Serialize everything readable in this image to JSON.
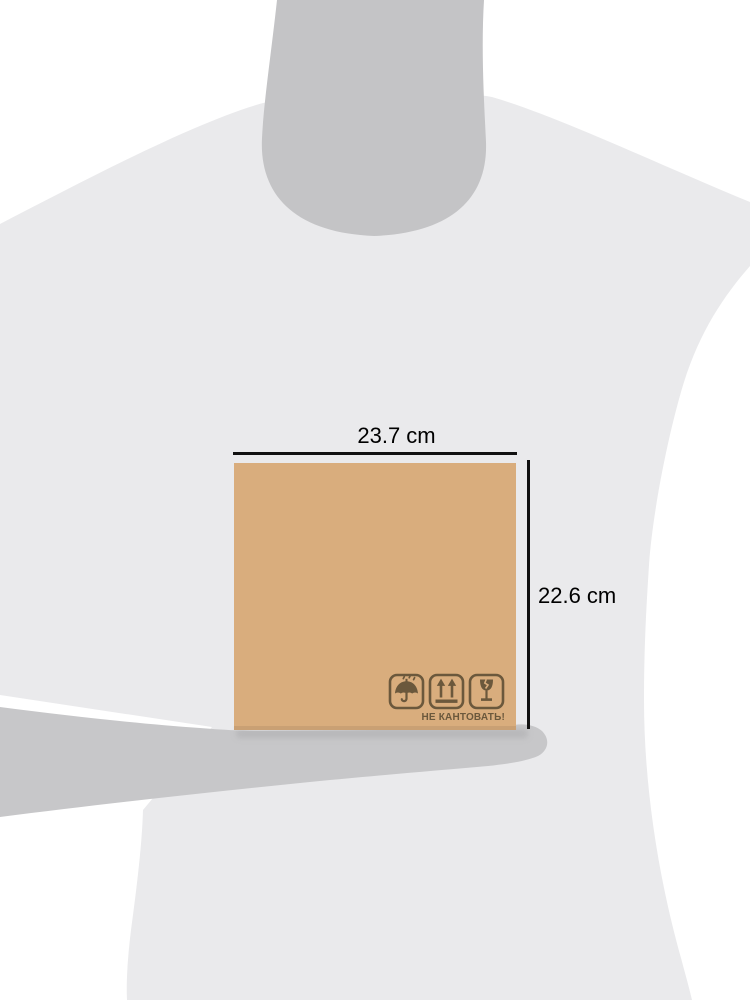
{
  "dimensions": {
    "width_label": "23.7 cm",
    "height_label": "22.6 cm",
    "line_color": "#111111",
    "text_color": "#000000"
  },
  "box": {
    "fill_color": "#d9ad7d",
    "bottom_edge_color": "#c89a6b",
    "marking_color": "#6b583c",
    "handling_label": "НЕ КАНТОВАТЬ!",
    "icons": [
      {
        "name": "keep-dry-icon"
      },
      {
        "name": "this-way-up-icon"
      },
      {
        "name": "fragile-icon"
      }
    ]
  },
  "silhouette": {
    "background_color": "#ffffff",
    "torso_color": "#eaeaec",
    "head_color": "#c4c4c6",
    "arm_color": "#c7c7c9",
    "shadow_color": "#a8a8aa"
  }
}
